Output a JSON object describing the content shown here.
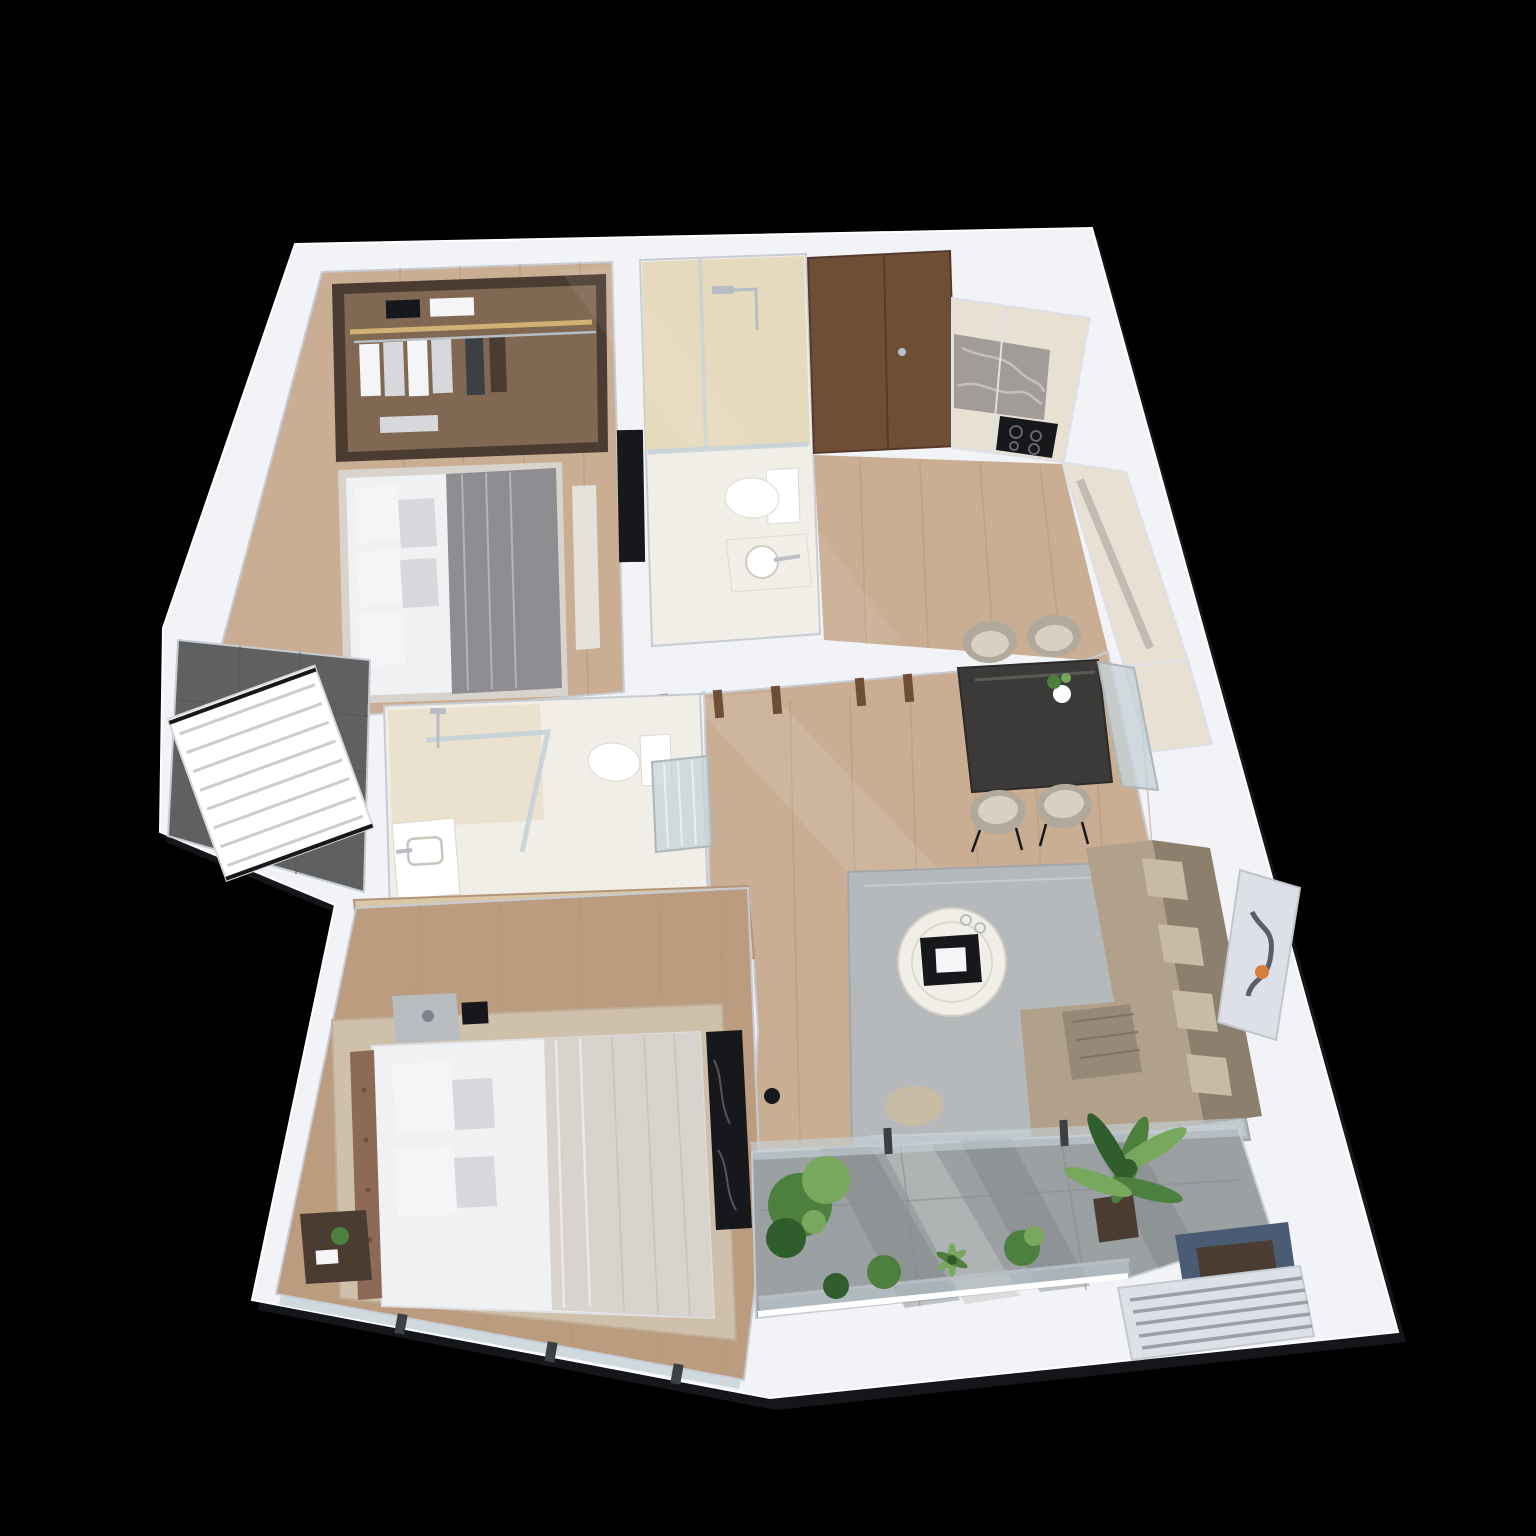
{
  "canvas": {
    "width": 1536,
    "height": 1536,
    "background": "#000000"
  },
  "scene": {
    "type": "3d-apartment-floor-plan-render",
    "view": "isometric-top-down",
    "units": 0,
    "rooms": [
      {
        "id": "bedroom-1",
        "furniture": [
          "walk-in-wardrobe",
          "double-bed",
          "bed-bench",
          "wall-tv"
        ]
      },
      {
        "id": "en-suite-bathroom",
        "furniture": [
          "walk-in-shower",
          "toilet",
          "round-basin"
        ]
      },
      {
        "id": "entrance",
        "furniture": [
          "entry-door"
        ]
      },
      {
        "id": "kitchen",
        "furniture": [
          "upper-cabinets",
          "marble-backsplash",
          "induction-cooktop",
          "counter-run",
          "tall-cabinet"
        ]
      },
      {
        "id": "dining-area",
        "furniture": [
          "dining-table",
          "dining-chair",
          "dining-chair",
          "dining-chair",
          "dining-chair",
          "flower-vase",
          "display-cabinet"
        ]
      },
      {
        "id": "living-room",
        "furniture": [
          "l-shaped-sofa",
          "throw-blanket",
          "coffee-table",
          "area-rug",
          "wall-art",
          "pouf",
          "pendant-lamp"
        ]
      },
      {
        "id": "corridor",
        "furniture": [
          "door-jambs"
        ]
      },
      {
        "id": "bathroom-2",
        "furniture": [
          "shower",
          "toilet",
          "vanity-basin",
          "sliding-glass-door"
        ]
      },
      {
        "id": "wardrobe-2",
        "furniture": [
          "closet-clothes"
        ]
      },
      {
        "id": "bedroom-2",
        "furniture": [
          "double-bed",
          "headboard",
          "nightstand-lamp",
          "nightstand-plant",
          "area-rug",
          "marble-tv-wall",
          "window-wall"
        ]
      },
      {
        "id": "utility-balcony",
        "furniture": [
          "drying-rack"
        ]
      },
      {
        "id": "balcony",
        "furniture": [
          "monstera-plant",
          "fern-plant",
          "leafy-plant",
          "agave-plant",
          "banana-palm",
          "planter-box",
          "glass-balustrade",
          "louver-vent"
        ]
      }
    ]
  },
  "palette": {
    "bg": "#000000",
    "slab": "#f2f3f6",
    "slab_shadow": "#14161a",
    "slab_edge": "#dde0e6",
    "wall_shadow": "#c7cbd3",
    "wood": "#c9ae93",
    "wood_warm": "#bb9c7e",
    "wood_line": "#b3957a",
    "maple": "#d9c7a6",
    "walnut": "#6f4e36",
    "walnut_dark": "#553a2b",
    "tile_beige": "#e6dabe",
    "tile_white": "#f0eee7",
    "tile_gray": "#5f6160",
    "tile_gray_line": "#515352",
    "terrazzo": "#9ba0a2",
    "terrazzo_dark": "#7e8487",
    "terrazzo_light": "#c3c6c4",
    "glass": "#c5d2d8",
    "frame_dark": "#3c4043",
    "marble": "#a29c99",
    "vein": "#dcd9d6",
    "cream": "#e7e0d3",
    "black": "#17181b",
    "table": "#3b3a38",
    "chair_shell": "#b1aa9c",
    "chair_seat": "#d7d0c3",
    "sofa": "#b2a18a",
    "sofa_light": "#c8bba3",
    "sofa_dark": "#8d7f6e",
    "throw": "#958a78",
    "rug_gray": "#b6b9bb",
    "rug_beige": "#cfc0ac",
    "bed_white": "#f0f1f3",
    "blanket": "#d8d3cd",
    "duvet": "#8d8d92",
    "pillow": "#f5f5f7",
    "pillow_gray": "#d8d8dc",
    "headboard": "#8c6a55",
    "closet": "#4a3c31",
    "closet_glow": "#806852",
    "gold": "#d9b878",
    "green": "#4d7f3e",
    "green_dark": "#2f5d2b",
    "green_light": "#78a85e",
    "planter": "#4a5c74",
    "planter_dark": "#394a5e",
    "chrome": "#b7bdc4",
    "white": "#ffffff",
    "bench": "#e5e2da",
    "nightstand": "#b9bcbf"
  }
}
